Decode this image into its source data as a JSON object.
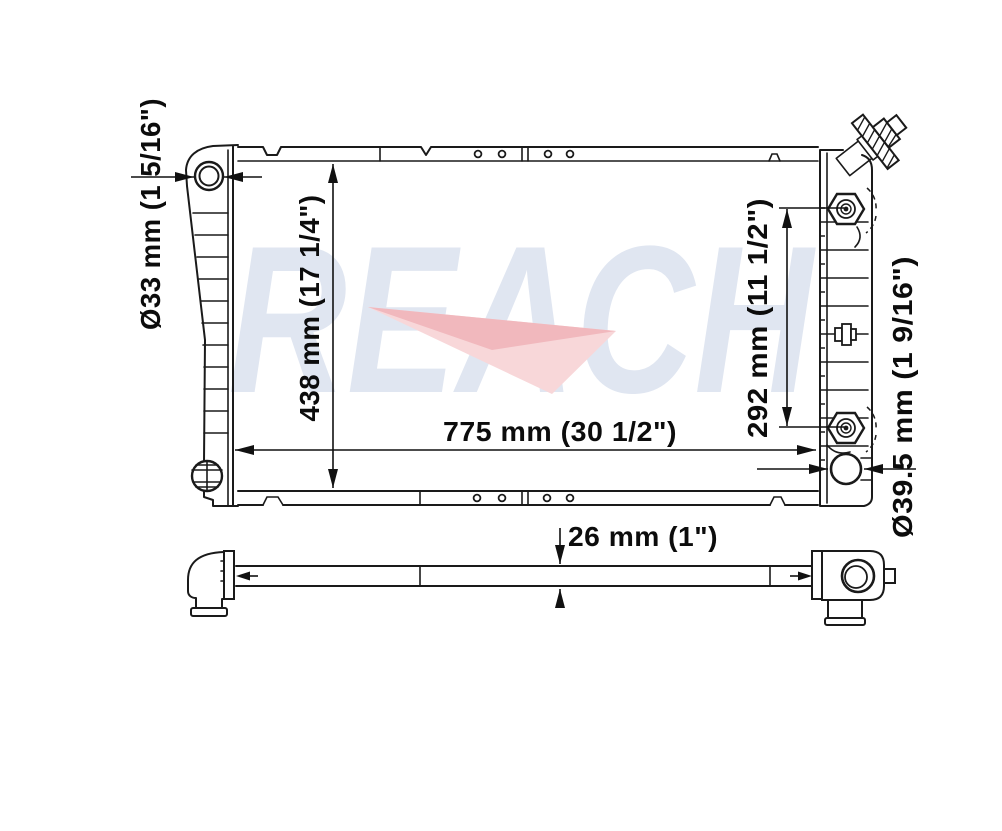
{
  "watermark": {
    "text": "REACH",
    "text_color": "#e0e6f1",
    "swoosh_light_color": "#f8d7d9",
    "swoosh_dark_color": "#f1b8bd"
  },
  "diagram": {
    "type": "technical-drawing",
    "subject": "automotive radiator, front view and side profile view"
  },
  "dimensions": {
    "inlet_diameter": {
      "label": "Ø33 mm (1 5/16\")",
      "orientation": "vertical"
    },
    "core_height": {
      "label": "438 mm (17 1/4\")",
      "orientation": "vertical"
    },
    "fitting_spacing": {
      "label": "292 mm (11 1/2\")",
      "orientation": "vertical"
    },
    "core_width": {
      "label": "775 mm (30 1/2\")",
      "orientation": "horizontal"
    },
    "outlet_diameter": {
      "label": "Ø39.5 mm (1 9/16\")",
      "orientation": "vertical"
    },
    "core_thickness": {
      "label": "26 mm (1\")",
      "orientation": "horizontal"
    }
  }
}
